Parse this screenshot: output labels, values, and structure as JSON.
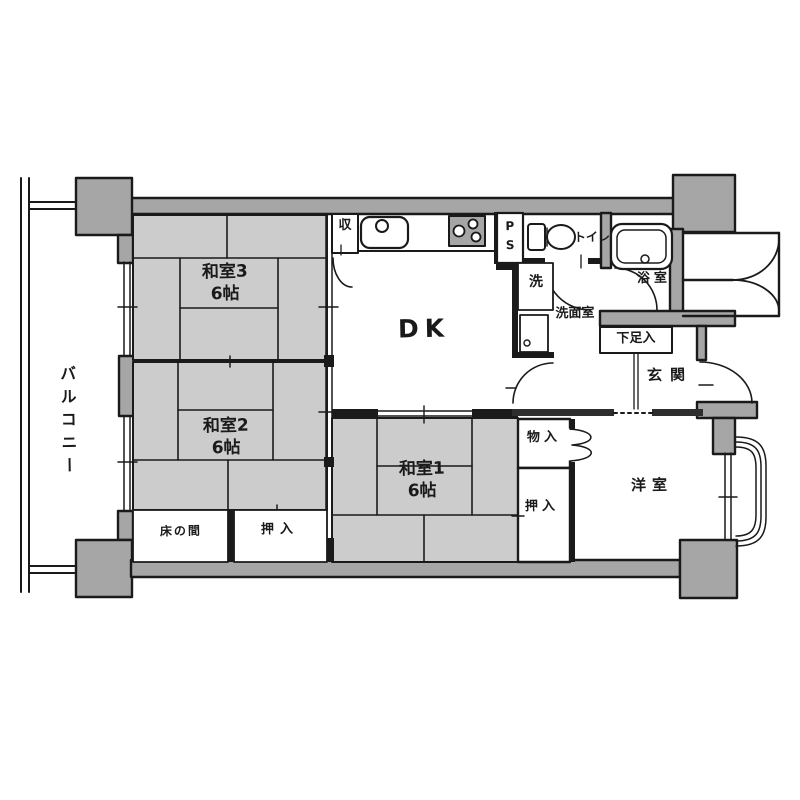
{
  "floorplan": {
    "balcony": {
      "label": "バルコニー"
    },
    "rooms": {
      "washitsu3": {
        "name": "和室3",
        "size": "6帖"
      },
      "washitsu2": {
        "name": "和室2",
        "size": "6帖"
      },
      "washitsu1": {
        "name": "和室1",
        "size": "6帖"
      },
      "dk": {
        "name": "DK"
      },
      "western_room": {
        "name": "洋室"
      },
      "entrance": {
        "name": "玄関"
      },
      "bathroom": {
        "name": "浴室"
      },
      "washroom": {
        "name": "洗面室"
      },
      "toilet": {
        "name": "トイレ"
      }
    },
    "storage": {
      "tokonoma": {
        "name": "床の間"
      },
      "oshiire_washitsu2": {
        "name": "押入"
      },
      "oshiire_washitsu1": {
        "name": "押入"
      },
      "monoire": {
        "name": "物入"
      },
      "shoe_cabinet": {
        "name": "下足入"
      },
      "kitchen_closet": {
        "name": "収"
      },
      "laundry_space": {
        "name": "洗"
      },
      "pipe_space": {
        "name": "P\nS"
      }
    },
    "colors": {
      "wall_gray": "#a6a6a6",
      "tatami_gray": "#cccccc",
      "line": "#1a1a1a",
      "background": "#ffffff"
    }
  }
}
